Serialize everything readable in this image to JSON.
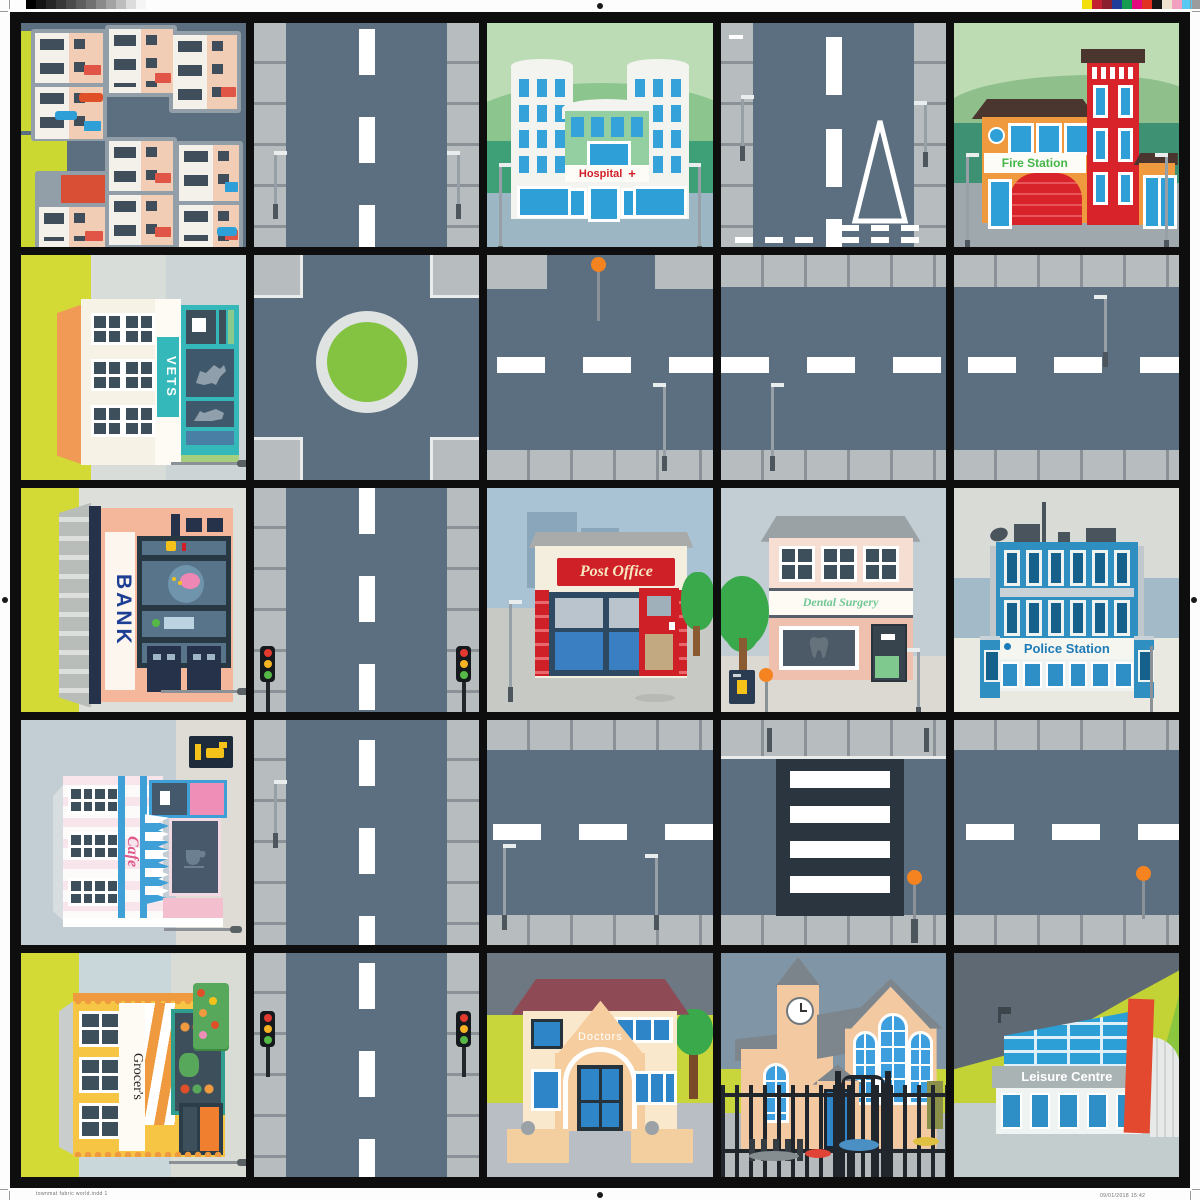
{
  "mat": {
    "grid_rows": 5,
    "grid_cols": 5,
    "colors": {
      "frame": "#0e0e0e",
      "road": "#5b6f80",
      "pavement": "#b7bcbf",
      "grass": "#ccd832",
      "roundabout_green": "#84c341",
      "marking_white": "#ffffff",
      "beacon_orange": "#f5831f",
      "traffic_red": "#e23a2e",
      "traffic_amber": "#f5b324",
      "traffic_green": "#56b847"
    }
  },
  "print_marks": {
    "filename_text": "townmat fabric world.indd   1",
    "timestamp_text": "09/01/2018   15:42",
    "grayscale_bar": [
      "#000000",
      "#141414",
      "#262626",
      "#383838",
      "#4b4b4b",
      "#5e5e5e",
      "#717171",
      "#8a8a8a",
      "#a3a3a3",
      "#bdbdbd",
      "#dcdcdc",
      "#f5f5f5"
    ],
    "color_bar": [
      "#f2df0d",
      "#c21f30",
      "#8c1f2e",
      "#1f3d99",
      "#169c4f",
      "#e5097f",
      "#e03123",
      "#171717",
      "#efe3cf",
      "#f2a0c0",
      "#57c8f2",
      "#9a9c9e"
    ]
  },
  "signs": {
    "hospital": "Hospital",
    "hospital_cross": "+",
    "fire_station": "Fire Station",
    "vets": "VETS",
    "bank": "BANK",
    "post_office": "Post Office",
    "dental_surgery": "Dental Surgery",
    "police_station": "Police Station",
    "cafe": "Cafe",
    "grocers": "Grocer's",
    "doctors": "Doctors",
    "leisure_centre": "Leisure Centre"
  },
  "tiles": {
    "row1": [
      "residential-houses",
      "road-vertical",
      "hospital",
      "road-vertical-give-way",
      "fire-station"
    ],
    "row2": [
      "vets",
      "roundabout",
      "road-horizontal-beacon",
      "road-horizontal",
      "road-horizontal"
    ],
    "row3": [
      "bank",
      "road-vertical-traffic-lights",
      "post-office",
      "dental-surgery",
      "police-station"
    ],
    "row4": [
      "cafe",
      "road-vertical",
      "road-horizontal",
      "zebra-crossing",
      "road-horizontal-beacon"
    ],
    "row5": [
      "grocers",
      "road-vertical-traffic-lights",
      "doctors",
      "church",
      "leisure-centre"
    ]
  }
}
